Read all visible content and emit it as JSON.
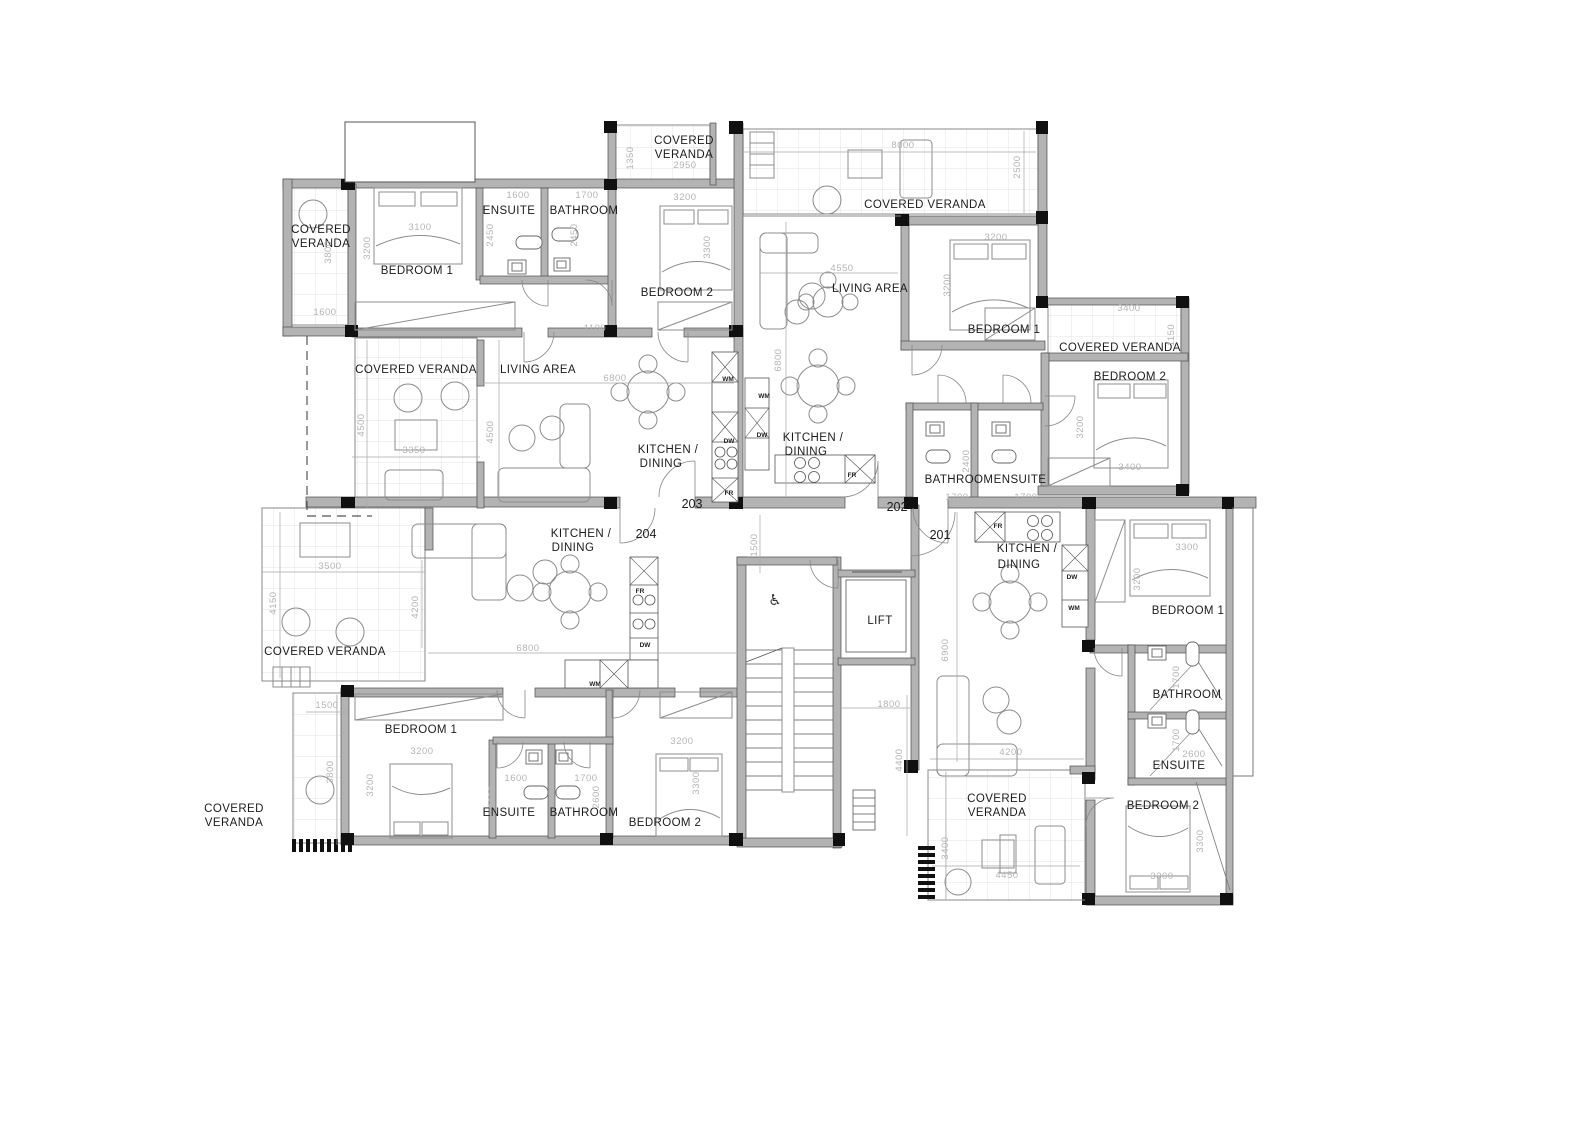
{
  "plan": {
    "title": "Apartment floor plan - level 2 (units 201-204)",
    "units": [
      "201",
      "202",
      "203",
      "204"
    ],
    "colors": {
      "wall": "#b3b3b3",
      "column": "#101010",
      "dimension_text": "#b4b4b4",
      "room_text": "#1c1c1c"
    },
    "labels": [
      {
        "t": "COVERED",
        "x": 321,
        "y": 233,
        "c": "room"
      },
      {
        "t": "VERANDA",
        "x": 321,
        "y": 247,
        "c": "room"
      },
      {
        "t": "BEDROOM 1",
        "x": 417,
        "y": 274,
        "c": "room"
      },
      {
        "t": "ENSUITE",
        "x": 509,
        "y": 214,
        "c": "room"
      },
      {
        "t": "BATHROOM",
        "x": 584,
        "y": 214,
        "c": "room"
      },
      {
        "t": "COVERED",
        "x": 684,
        "y": 144,
        "c": "room"
      },
      {
        "t": "VERANDA",
        "x": 684,
        "y": 158,
        "c": "room"
      },
      {
        "t": "BEDROOM 2",
        "x": 677,
        "y": 296,
        "c": "room"
      },
      {
        "t": "COVERED VERANDA",
        "x": 925,
        "y": 208,
        "c": "room"
      },
      {
        "t": "LIVING AREA",
        "x": 870,
        "y": 292,
        "c": "room"
      },
      {
        "t": "BEDROOM 1",
        "x": 1004,
        "y": 333,
        "c": "room"
      },
      {
        "t": "COVERED VERANDA",
        "x": 1120,
        "y": 351,
        "c": "room"
      },
      {
        "t": "BEDROOM 2",
        "x": 1130,
        "y": 380,
        "c": "room"
      },
      {
        "t": "LIVING AREA",
        "x": 538,
        "y": 373,
        "c": "room"
      },
      {
        "t": "COVERED VERANDA",
        "x": 416,
        "y": 373,
        "c": "room"
      },
      {
        "t": "KITCHEN /",
        "x": 668,
        "y": 453,
        "c": "room"
      },
      {
        "t": "DINING",
        "x": 661,
        "y": 467,
        "c": "room"
      },
      {
        "t": "KITCHEN /",
        "x": 813,
        "y": 441,
        "c": "room"
      },
      {
        "t": "DINING",
        "x": 806,
        "y": 455,
        "c": "room"
      },
      {
        "t": "BATHROOM",
        "x": 959,
        "y": 483,
        "c": "room"
      },
      {
        "t": "ENSUITE",
        "x": 1020,
        "y": 483,
        "c": "room"
      },
      {
        "t": "KITCHEN /",
        "x": 581,
        "y": 537,
        "c": "room"
      },
      {
        "t": "DINING",
        "x": 573,
        "y": 551,
        "c": "room"
      },
      {
        "t": "KITCHEN /",
        "x": 1027,
        "y": 552,
        "c": "room"
      },
      {
        "t": "DINING",
        "x": 1019,
        "y": 568,
        "c": "room"
      },
      {
        "t": "BEDROOM 1",
        "x": 1188,
        "y": 614,
        "c": "room"
      },
      {
        "t": "BATHROOM",
        "x": 1187,
        "y": 698,
        "c": "room"
      },
      {
        "t": "ENSUITE",
        "x": 1179,
        "y": 769,
        "c": "room"
      },
      {
        "t": "BEDROOM 2",
        "x": 1163,
        "y": 809,
        "c": "room"
      },
      {
        "t": "COVERED",
        "x": 997,
        "y": 802,
        "c": "room"
      },
      {
        "t": "VERANDA",
        "x": 997,
        "y": 816,
        "c": "room"
      },
      {
        "t": "COVERED VERANDA",
        "x": 325,
        "y": 655,
        "c": "room"
      },
      {
        "t": "BEDROOM 1",
        "x": 421,
        "y": 733,
        "c": "room"
      },
      {
        "t": "ENSUITE",
        "x": 509,
        "y": 816,
        "c": "room"
      },
      {
        "t": "BATHROOM",
        "x": 584,
        "y": 816,
        "c": "room"
      },
      {
        "t": "BEDROOM 2",
        "x": 665,
        "y": 826,
        "c": "room"
      },
      {
        "t": "COVERED",
        "x": 234,
        "y": 812,
        "c": "room"
      },
      {
        "t": "VERANDA",
        "x": 234,
        "y": 826,
        "c": "room"
      },
      {
        "t": "LIFT",
        "x": 880,
        "y": 624,
        "c": "room"
      },
      {
        "t": "203",
        "x": 692,
        "y": 508,
        "c": "unit"
      },
      {
        "t": "204",
        "x": 646,
        "y": 538,
        "c": "unit"
      },
      {
        "t": "202",
        "x": 897,
        "y": 511,
        "c": "unit"
      },
      {
        "t": "201",
        "x": 940,
        "y": 539,
        "c": "unit"
      },
      {
        "t": "3800",
        "x": 331,
        "y": 252,
        "c": "dim",
        "r": 1
      },
      {
        "t": "1600",
        "x": 325,
        "y": 315,
        "c": "dim"
      },
      {
        "t": "3100",
        "x": 420,
        "y": 230,
        "c": "dim"
      },
      {
        "t": "3200",
        "x": 370,
        "y": 248,
        "c": "dim",
        "r": 1
      },
      {
        "t": "1600",
        "x": 518,
        "y": 198,
        "c": "dim"
      },
      {
        "t": "2450",
        "x": 493,
        "y": 235,
        "c": "dim",
        "r": 1
      },
      {
        "t": "1700",
        "x": 587,
        "y": 198,
        "c": "dim"
      },
      {
        "t": "2450",
        "x": 577,
        "y": 235,
        "c": "dim",
        "r": 1
      },
      {
        "t": "2950",
        "x": 685,
        "y": 168,
        "c": "dim"
      },
      {
        "t": "1350",
        "x": 633,
        "y": 158,
        "c": "dim",
        "r": 1
      },
      {
        "t": "3200",
        "x": 685,
        "y": 200,
        "c": "dim"
      },
      {
        "t": "3300",
        "x": 710,
        "y": 247,
        "c": "dim",
        "r": 1
      },
      {
        "t": "1100",
        "x": 595,
        "y": 331,
        "c": "dim"
      },
      {
        "t": "6800",
        "x": 615,
        "y": 381,
        "c": "dim"
      },
      {
        "t": "8000",
        "x": 903,
        "y": 148,
        "c": "dim"
      },
      {
        "t": "2500",
        "x": 1020,
        "y": 167,
        "c": "dim",
        "r": 1
      },
      {
        "t": "4550",
        "x": 842,
        "y": 271,
        "c": "dim"
      },
      {
        "t": "6800",
        "x": 781,
        "y": 360,
        "c": "dim",
        "r": 1
      },
      {
        "t": "3200",
        "x": 996,
        "y": 240,
        "c": "dim"
      },
      {
        "t": "3200",
        "x": 950,
        "y": 285,
        "c": "dim",
        "r": 1
      },
      {
        "t": "3400",
        "x": 1129,
        "y": 311,
        "c": "dim"
      },
      {
        "t": "1150",
        "x": 1174,
        "y": 335,
        "c": "dim",
        "r": 1
      },
      {
        "t": "3200",
        "x": 1083,
        "y": 427,
        "c": "dim",
        "r": 1
      },
      {
        "t": "3400",
        "x": 1130,
        "y": 470,
        "c": "dim"
      },
      {
        "t": "2400",
        "x": 969,
        "y": 461,
        "c": "dim",
        "r": 1
      },
      {
        "t": "1700",
        "x": 957,
        "y": 500,
        "c": "dim"
      },
      {
        "t": "1700",
        "x": 1026,
        "y": 500,
        "c": "dim"
      },
      {
        "t": "4500",
        "x": 364,
        "y": 425,
        "c": "dim",
        "r": 1
      },
      {
        "t": "3350",
        "x": 414,
        "y": 453,
        "c": "dim"
      },
      {
        "t": "4500",
        "x": 493,
        "y": 432,
        "c": "dim",
        "r": 1
      },
      {
        "t": "3500",
        "x": 330,
        "y": 569,
        "c": "dim"
      },
      {
        "t": "4150",
        "x": 276,
        "y": 603,
        "c": "dim",
        "r": 1
      },
      {
        "t": "6800",
        "x": 528,
        "y": 651,
        "c": "dim"
      },
      {
        "t": "4200",
        "x": 418,
        "y": 607,
        "c": "dim",
        "r": 1
      },
      {
        "t": "1500",
        "x": 327,
        "y": 708,
        "c": "dim"
      },
      {
        "t": "3800",
        "x": 333,
        "y": 772,
        "c": "dim",
        "r": 1
      },
      {
        "t": "3200",
        "x": 422,
        "y": 754,
        "c": "dim"
      },
      {
        "t": "3200",
        "x": 373,
        "y": 785,
        "c": "dim",
        "r": 1
      },
      {
        "t": "1600",
        "x": 516,
        "y": 781,
        "c": "dim"
      },
      {
        "t": "2600",
        "x": 495,
        "y": 797,
        "c": "dim",
        "r": 1
      },
      {
        "t": "1700",
        "x": 586,
        "y": 781,
        "c": "dim"
      },
      {
        "t": "2600",
        "x": 599,
        "y": 797,
        "c": "dim",
        "r": 1
      },
      {
        "t": "3200",
        "x": 682,
        "y": 744,
        "c": "dim"
      },
      {
        "t": "3300",
        "x": 699,
        "y": 783,
        "c": "dim",
        "r": 1
      },
      {
        "t": "1500",
        "x": 757,
        "y": 545,
        "c": "dim",
        "r": 1
      },
      {
        "t": "1800",
        "x": 889,
        "y": 707,
        "c": "dim"
      },
      {
        "t": "4400",
        "x": 902,
        "y": 760,
        "c": "dim",
        "r": 1
      },
      {
        "t": "6900",
        "x": 948,
        "y": 650,
        "c": "dim",
        "r": 1
      },
      {
        "t": "4200",
        "x": 1011,
        "y": 755,
        "c": "dim"
      },
      {
        "t": "3400",
        "x": 948,
        "y": 848,
        "c": "dim",
        "r": 1
      },
      {
        "t": "4450",
        "x": 1007,
        "y": 878,
        "c": "dim"
      },
      {
        "t": "3300",
        "x": 1187,
        "y": 550,
        "c": "dim"
      },
      {
        "t": "3200",
        "x": 1140,
        "y": 579,
        "c": "dim",
        "r": 1
      },
      {
        "t": "1700",
        "x": 1179,
        "y": 677,
        "c": "dim",
        "r": 1
      },
      {
        "t": "1700",
        "x": 1179,
        "y": 740,
        "c": "dim",
        "r": 1
      },
      {
        "t": "2600",
        "x": 1194,
        "y": 757,
        "c": "dim"
      },
      {
        "t": "3300",
        "x": 1162,
        "y": 879,
        "c": "dim"
      },
      {
        "t": "3300",
        "x": 1203,
        "y": 841,
        "c": "dim",
        "r": 1
      },
      {
        "t": "WM",
        "x": 728,
        "y": 381,
        "c": "tag"
      },
      {
        "t": "WM",
        "x": 764,
        "y": 398,
        "c": "tag"
      },
      {
        "t": "DW",
        "x": 729,
        "y": 443,
        "c": "tag"
      },
      {
        "t": "DW",
        "x": 762,
        "y": 437,
        "c": "tag"
      },
      {
        "t": "FR",
        "x": 729,
        "y": 495,
        "c": "tag"
      },
      {
        "t": "FR",
        "x": 852,
        "y": 477,
        "c": "tag"
      },
      {
        "t": "FR",
        "x": 640,
        "y": 593,
        "c": "tag"
      },
      {
        "t": "DW",
        "x": 645,
        "y": 647,
        "c": "tag"
      },
      {
        "t": "WM",
        "x": 595,
        "y": 686,
        "c": "tag"
      },
      {
        "t": "FR",
        "x": 998,
        "y": 528,
        "c": "tag"
      },
      {
        "t": "DW",
        "x": 1072,
        "y": 579,
        "c": "tag"
      },
      {
        "t": "WM",
        "x": 1074,
        "y": 610,
        "c": "tag"
      },
      {
        "t": "♿",
        "x": 775,
        "y": 605,
        "c": "icon"
      }
    ]
  }
}
